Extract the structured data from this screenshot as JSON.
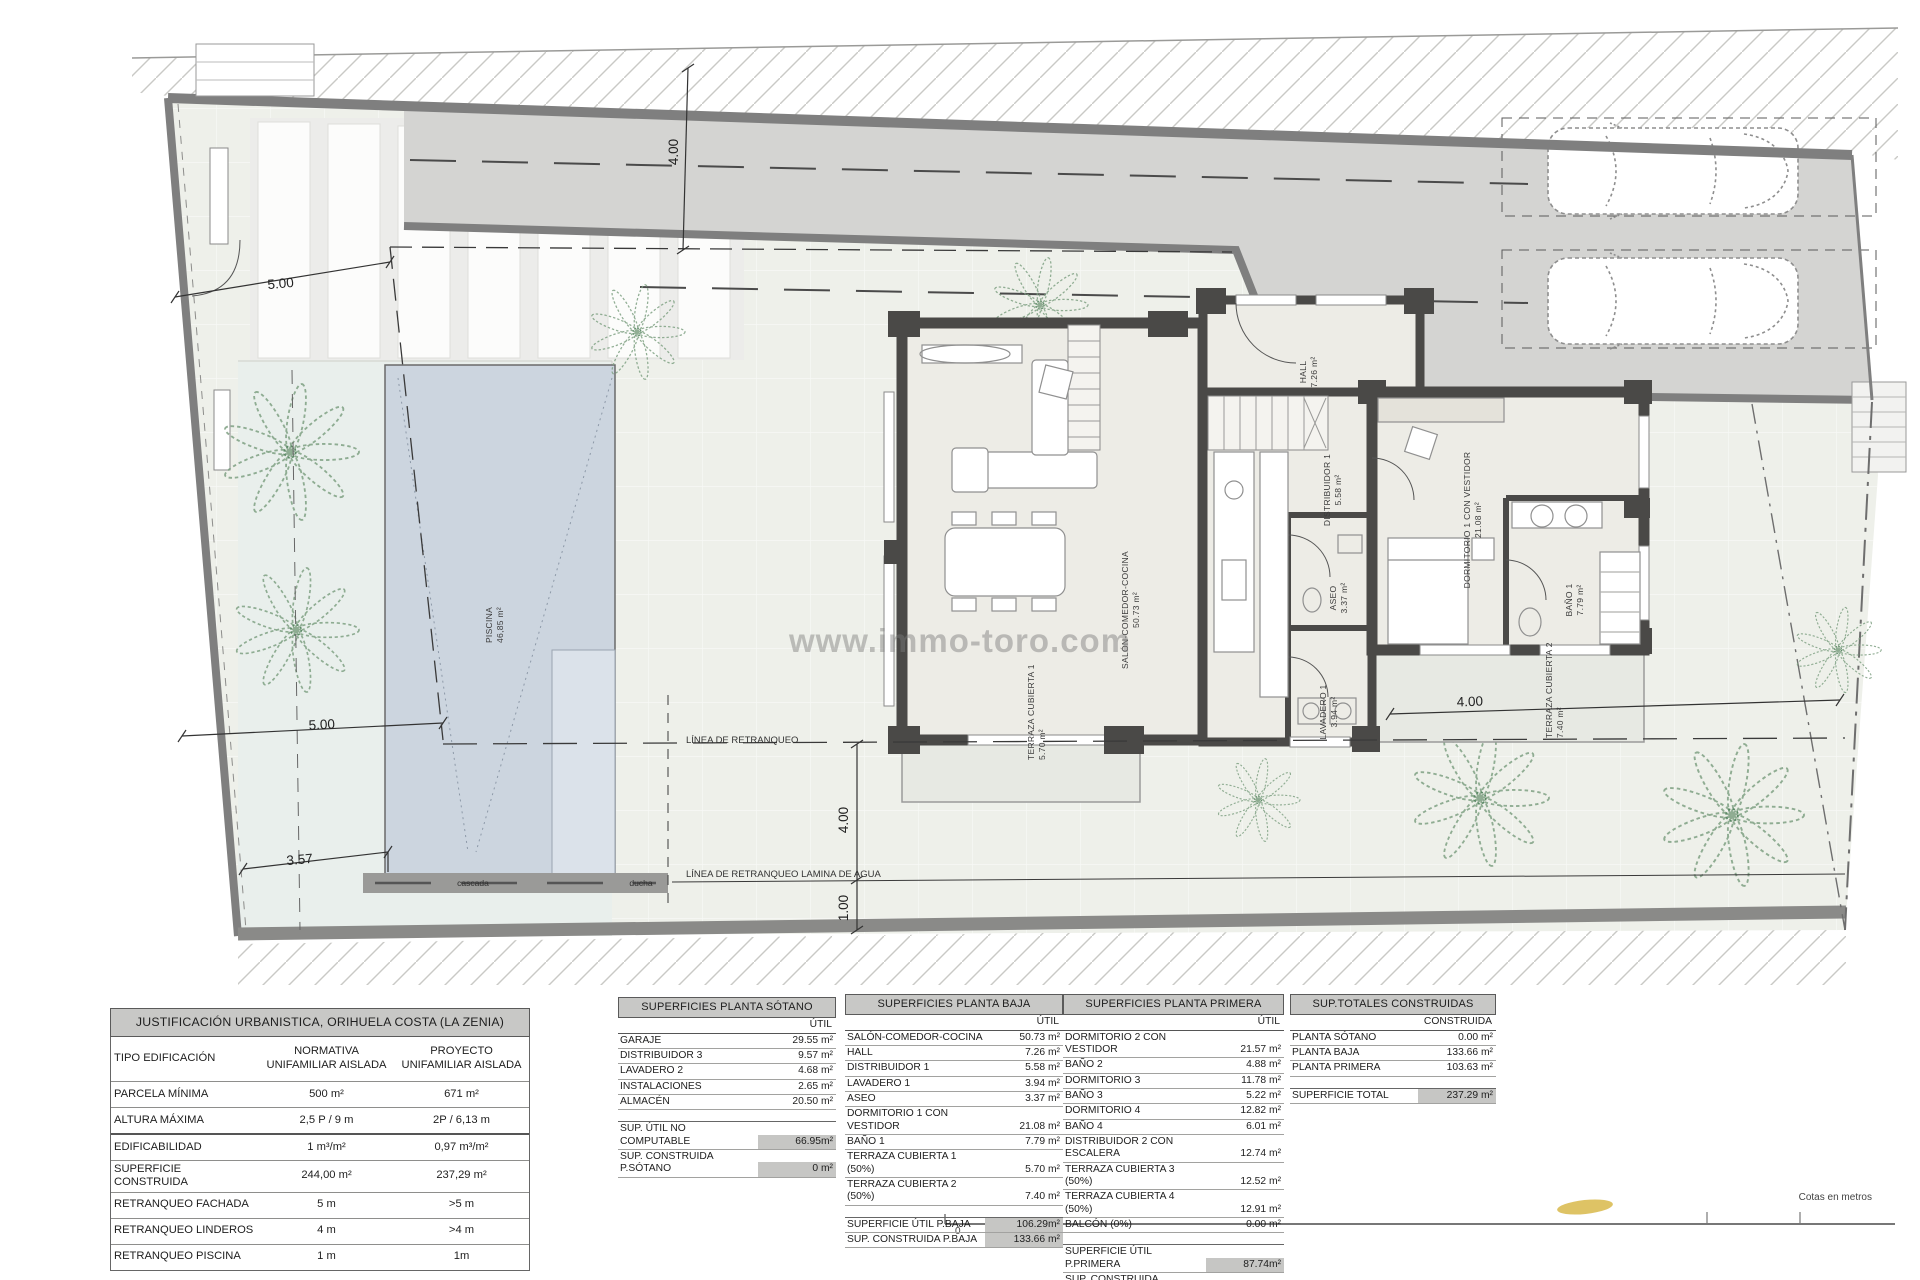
{
  "plan": {
    "watermark": "www.immo-toro.com",
    "dims": {
      "front": "5.00",
      "top_vert": "4.00",
      "mid": "5.00",
      "pool": "3.57",
      "setback4": "4.00",
      "setback1": "1.00",
      "right": "4.00"
    },
    "lines": {
      "retranqueo": "LÍNEA DE RETRANQUEO",
      "retranqueo_agua": "LÍNEA DE RETRANQUEO LAMINA DE AGUA"
    },
    "features": {
      "cascada": "cascada",
      "ducha": "ducha"
    },
    "rooms": {
      "piscina": {
        "n": "PISCINA",
        "a": "46,85 m²"
      },
      "hall": {
        "n": "HALL",
        "a": "7.26 m²"
      },
      "salon": {
        "n": "SALÓN-COMEDOR-COCINA",
        "a": "50.73 m²"
      },
      "distribuidor": {
        "n": "DISTRIBUIDOR 1",
        "a": "5.58 m²"
      },
      "aseo": {
        "n": "ASEO",
        "a": "3.37 m²"
      },
      "lavadero": {
        "n": "LAVADERO 1",
        "a": "3.94 m²"
      },
      "dormitorio1": {
        "n": "DORMITORIO 1 CON VESTIDOR",
        "a": "21.08 m²"
      },
      "bano1": {
        "n": "BAÑO 1",
        "a": "7.79 m²"
      },
      "terraza1": {
        "n": "TERRAZA CUBIERTA 1",
        "a": "5.70 m²"
      },
      "terraza2": {
        "n": "TERRAZA CUBIERTA 2",
        "a": "7.40 m²"
      }
    },
    "scalebar": {
      "zero": "0",
      "caption": "Cotas en metros"
    },
    "colors": {
      "boundary_wall": "#7f7f7f",
      "house_wall": "#4a4947",
      "driveway": "#d4d4d2",
      "site": "#eef0ea",
      "garden": "#e9efec",
      "room": "#edece6",
      "pool": "#ccd5df",
      "pool_shelf": "#dbe2ea",
      "palm": "#7fa183",
      "table_header_bg": "#c8c8c6",
      "highlight_bg": "#c6c6c4",
      "scale_marker": "#d8b84a",
      "watermark_gray": "#7a7a7a"
    }
  },
  "tables": {
    "justificacion": {
      "title": "JUSTIFICACIÓN URBANISTICA, ORIHUELA COSTA (LA ZENIA)",
      "rows": [
        {
          "label": "TIPO EDIFICACIÓN",
          "normativa": "NORMATIVA\nUNIFAMILIAR AISLADA",
          "proyecto": "PROYECTO\nUNIFAMILIAR AISLADA"
        },
        {
          "label": "PARCELA MÍNIMA",
          "normativa": "500 m²",
          "proyecto": "671 m²"
        },
        {
          "label": "ALTURA MÁXIMA",
          "normativa": "2,5 P / 9 m",
          "proyecto": "2P / 6,13 m"
        },
        {
          "label": "EDIFICABILIDAD",
          "normativa": "1 m³/m²",
          "proyecto": "0,97 m³/m²"
        },
        {
          "label": "SUPERFICIE CONSTRUIDA",
          "normativa": "244,00 m²",
          "proyecto": "237,29 m²"
        },
        {
          "label": "RETRANQUEO FACHADA",
          "normativa": "5 m",
          "proyecto": ">5 m"
        },
        {
          "label": "RETRANQUEO LINDEROS",
          "normativa": "4 m",
          "proyecto": ">4 m"
        },
        {
          "label": "RETRANQUEO PISCINA",
          "normativa": "1 m",
          "proyecto": "1m"
        }
      ]
    },
    "sotano": {
      "title": "SUPERFICIES PLANTA SÓTANO",
      "col": "ÚTIL",
      "rows": [
        {
          "label": "GARAJE",
          "value": "29.55 m²"
        },
        {
          "label": "DISTRIBUIDOR 3",
          "value": "9.57 m²"
        },
        {
          "label": "LAVADERO 2",
          "value": "4.68 m²"
        },
        {
          "label": "INSTALACIONES",
          "value": "2.65 m²"
        },
        {
          "label": "ALMACÉN",
          "value": "20.50 m²"
        }
      ],
      "totals": [
        {
          "label": "SUP. ÚTIL NO COMPUTABLE",
          "value": "66.95m²"
        },
        {
          "label": "SUP. CONSTRUIDA P.SÓTANO",
          "value": "0 m²"
        }
      ]
    },
    "baja": {
      "title": "SUPERFICIES PLANTA BAJA",
      "col": "ÚTIL",
      "rows": [
        {
          "label": "SALÓN-COMEDOR-COCINA",
          "value": "50.73 m²"
        },
        {
          "label": "HALL",
          "value": "7.26 m²"
        },
        {
          "label": "DISTRIBUIDOR 1",
          "value": "5.58 m²"
        },
        {
          "label": "LAVADERO 1",
          "value": "3.94 m²"
        },
        {
          "label": "ASEO",
          "value": "3.37 m²"
        },
        {
          "label": "DORMITORIO 1 CON VESTIDOR",
          "value": "21.08 m²"
        },
        {
          "label": "BAÑO 1",
          "value": "7.79 m²"
        },
        {
          "label": "TERRAZA CUBIERTA 1 (50%)",
          "value": "5.70 m²"
        },
        {
          "label": "TERRAZA CUBIERTA 2 (50%)",
          "value": "7.40 m²"
        }
      ],
      "totals": [
        {
          "label": "SUPERFICIE ÚTIL P.BAJA",
          "value": "106.29m²"
        },
        {
          "label": "SUP. CONSTRUIDA P.BAJA",
          "value": "133.66 m²"
        }
      ]
    },
    "primera": {
      "title": "SUPERFICIES PLANTA PRIMERA",
      "col": "ÚTIL",
      "rows": [
        {
          "label": "DORMITORIO 2 CON VESTIDOR",
          "value": "21.57 m²"
        },
        {
          "label": "BAÑO 2",
          "value": "4.88 m²"
        },
        {
          "label": "DORMITORIO 3",
          "value": "11.78 m²"
        },
        {
          "label": "BAÑO 3",
          "value": "5.22 m²"
        },
        {
          "label": "DORMITORIO 4",
          "value": "12.82 m²"
        },
        {
          "label": "BAÑO 4",
          "value": "6.01 m²"
        },
        {
          "label": "DISTRIBUIDOR 2 CON ESCALERA",
          "value": "12.74 m²"
        },
        {
          "label": "TERRAZA CUBIERTA 3 (50%)",
          "value": "12.52 m²"
        },
        {
          "label": "TERRAZA CUBIERTA 4 (50%)",
          "value": "12.91 m²"
        },
        {
          "label": "BALCÓN (0%)",
          "value": "0.00 m²"
        }
      ],
      "totals": [
        {
          "label": "SUPERFICIE ÚTIL P.PRIMERA",
          "value": "87.74m²"
        },
        {
          "label": "SUP. CONSTRUIDA P.PRIMERA",
          "value": "103.63 m²"
        }
      ]
    },
    "totales": {
      "title": "SUP.TOTALES CONSTRUIDAS",
      "col": "CONSTRUIDA",
      "rows": [
        {
          "label": "PLANTA SÓTANO",
          "value": "0.00 m²"
        },
        {
          "label": "PLANTA BAJA",
          "value": "133.66 m²"
        },
        {
          "label": "PLANTA PRIMERA",
          "value": "103.63 m²"
        }
      ],
      "totals": [
        {
          "label": "SUPERFICIE TOTAL",
          "value": "237.29 m²"
        }
      ]
    }
  }
}
